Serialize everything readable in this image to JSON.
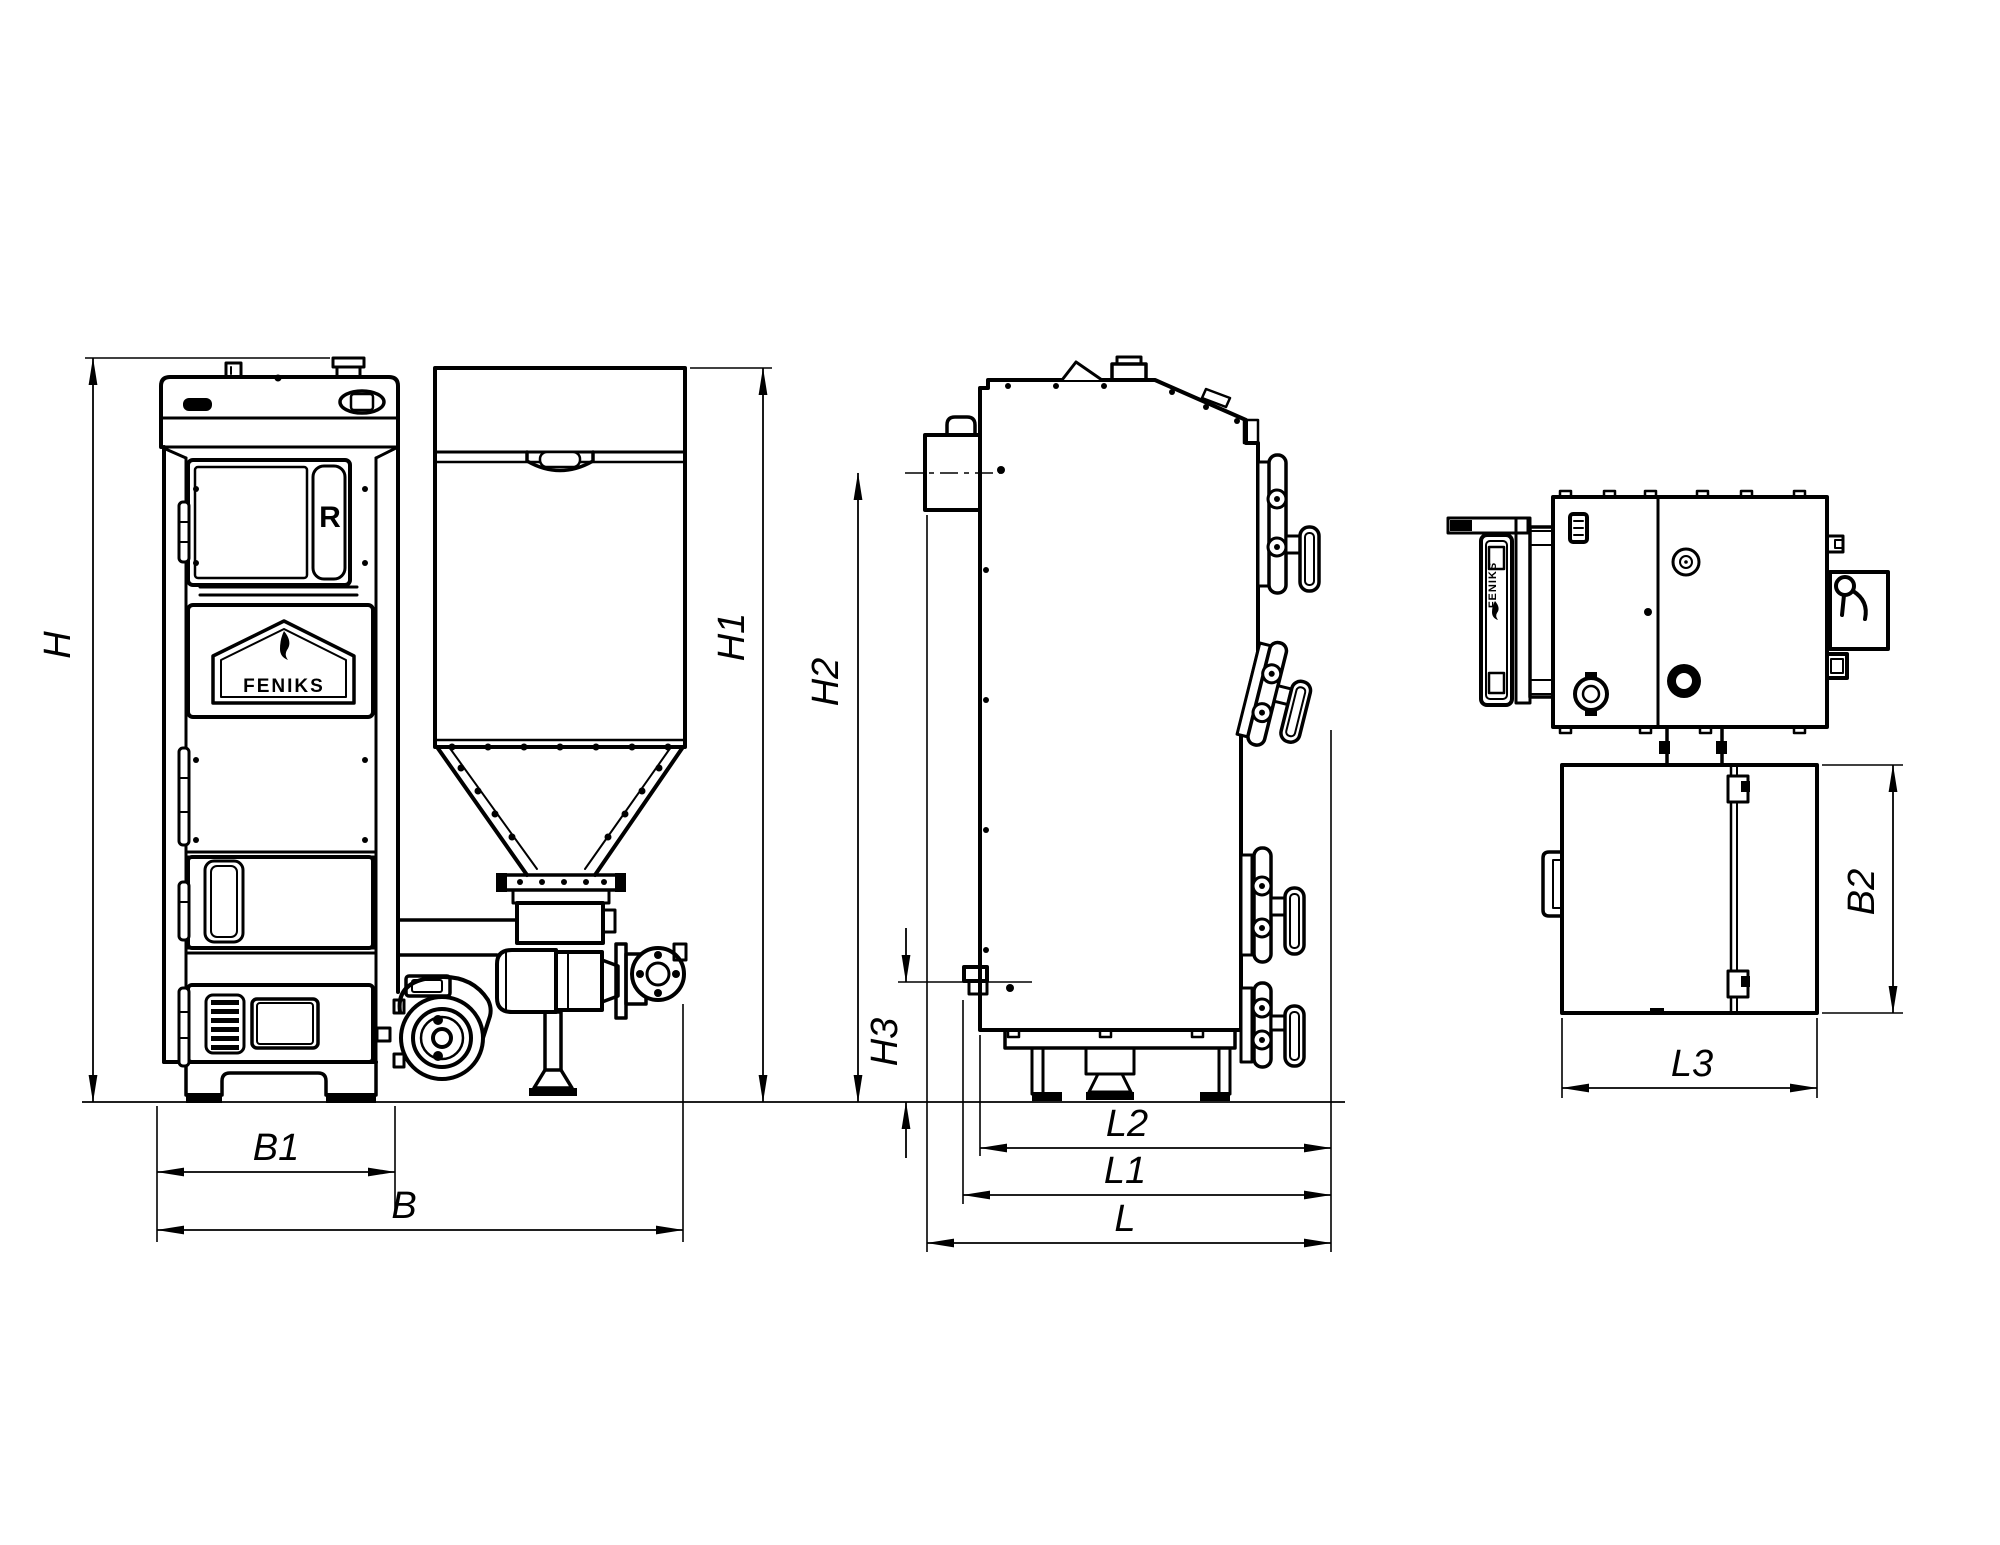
{
  "page": {
    "background": "#ffffff",
    "ink": "#000000"
  },
  "drawing": {
    "brand": "FENIKS",
    "front_view": {
      "regulator_marking": "R",
      "door_brand": "FENIKS"
    },
    "top_view": {
      "door_brand": "FENIKS"
    },
    "dimensions": {
      "H": "H",
      "H1": "H1",
      "H2": "H2",
      "H3": "H3",
      "B": "B",
      "B1": "B1",
      "B2": "B2",
      "L": "L",
      "L1": "L1",
      "L2": "L2",
      "L3": "L3"
    }
  }
}
